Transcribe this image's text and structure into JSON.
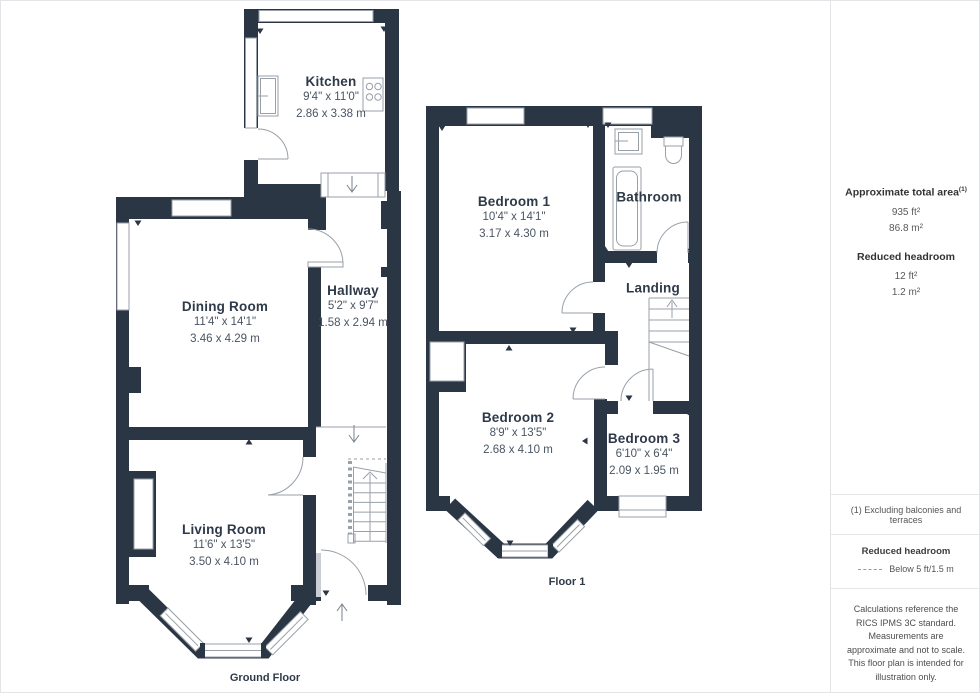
{
  "plan": {
    "ground": {
      "title": "Ground Floor",
      "rooms": {
        "kitchen": {
          "name": "Kitchen",
          "dims_ft": "9'4\" x 11'0\"",
          "dims_m": "2.86 x 3.38 m"
        },
        "dining": {
          "name": "Dining Room",
          "dims_ft": "11'4\" x 14'1\"",
          "dims_m": "3.46 x 4.29 m"
        },
        "hallway": {
          "name": "Hallway",
          "dims_ft": "5'2\" x 9'7\"",
          "dims_m": "1.58 x 2.94 m"
        },
        "living": {
          "name": "Living Room",
          "dims_ft": "11'6\" x 13'5\"",
          "dims_m": "3.50 x 4.10 m"
        }
      }
    },
    "floor1": {
      "title": "Floor 1",
      "rooms": {
        "bedroom1": {
          "name": "Bedroom 1",
          "dims_ft": "10'4\" x 14'1\"",
          "dims_m": "3.17 x 4.30 m"
        },
        "bathroom": {
          "name": "Bathroom"
        },
        "landing": {
          "name": "Landing"
        },
        "bedroom2": {
          "name": "Bedroom 2",
          "dims_ft": "8'9\" x 13'5\"",
          "dims_m": "2.68 x 4.10 m"
        },
        "bedroom3": {
          "name": "Bedroom 3",
          "dims_ft": "6'10\" x 6'4\"",
          "dims_m": "2.09 x 1.95 m"
        }
      }
    }
  },
  "sidebar": {
    "total_area": {
      "label": "Approximate total area",
      "superscript": "(1)",
      "value_ft": "935 ft²",
      "value_m": "86.8 m²"
    },
    "reduced_headroom": {
      "label": "Reduced headroom",
      "value_ft": "12 ft²",
      "value_m": "1.2 m²"
    },
    "footnote": "(1) Excluding balconies and terraces",
    "legend": {
      "label": "Reduced headroom",
      "item": "Below 5 ft/1.5 m"
    },
    "disclaimer": "Calculations reference the RICS IPMS 3C standard. Measurements are approximate and not to scale. This floor plan is intended for illustration only.",
    "brand": {
      "name": "GIRAFFE",
      "suffix": "360"
    }
  },
  "colors": {
    "wall": "#2b3645",
    "line": "#98a0a8",
    "text": "#2e3a49"
  }
}
